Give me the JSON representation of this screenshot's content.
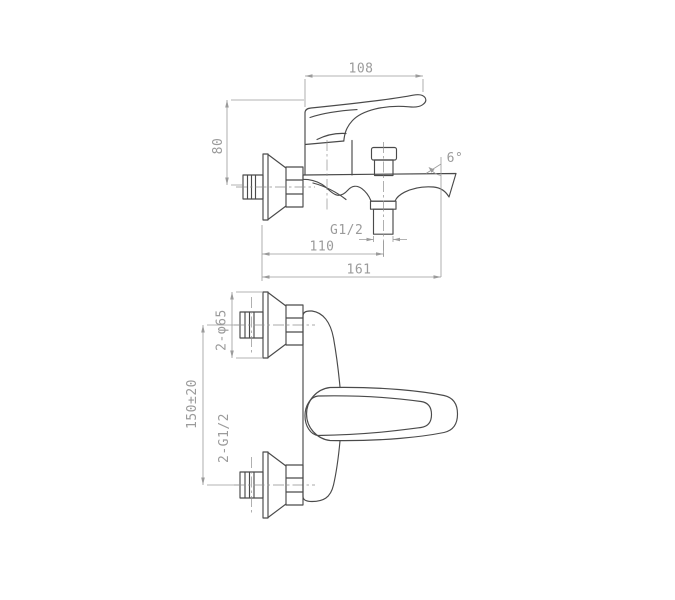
{
  "canvas": {
    "background": "#ffffff",
    "geometry_line_color": "#4a4a4a",
    "dimension_color": "#9b9b9b"
  },
  "dims": {
    "handle_length": "108",
    "body_height": "80",
    "outlet_thread": "G1/2",
    "outlet_offset": "110",
    "total_projection": "161",
    "spout_angle": "6°",
    "escutcheon_diameter": "2-φ65",
    "inlet_spacing": "150±20",
    "inlet_thread": "2-G1/2"
  }
}
